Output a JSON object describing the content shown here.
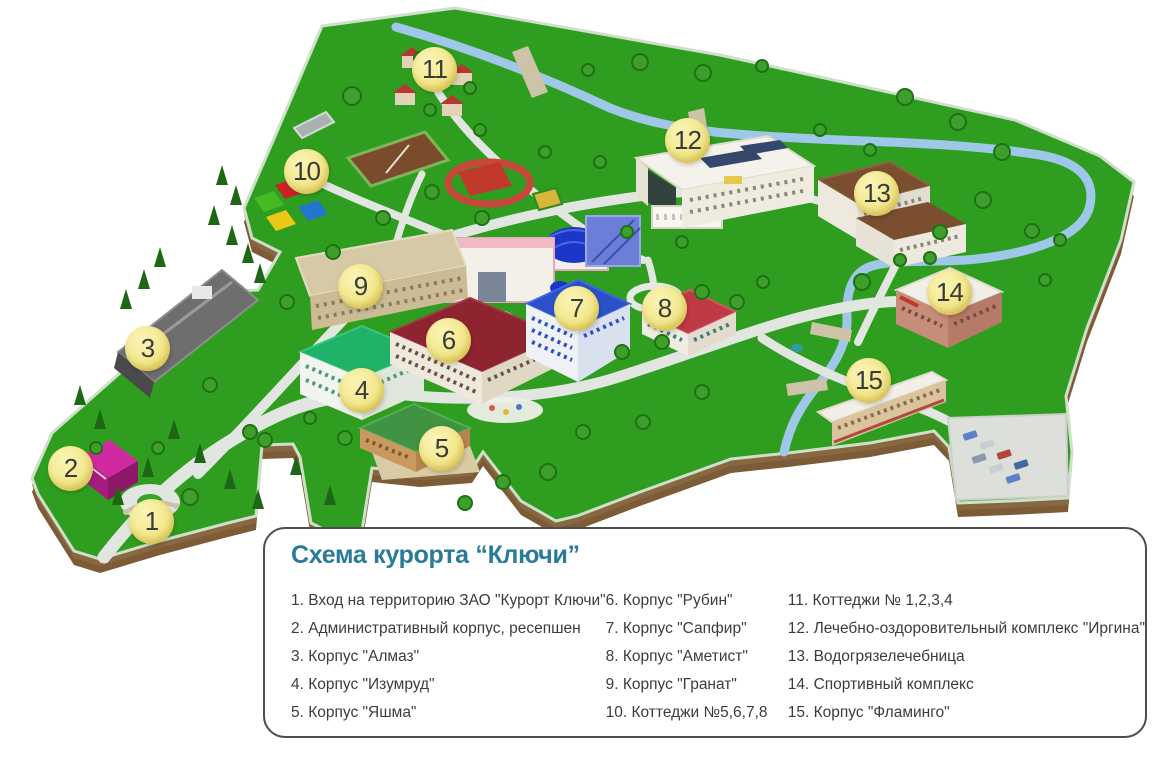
{
  "page": {
    "background": "#FFFFFF"
  },
  "legend": {
    "title": "Схема курорта “Ключи”",
    "title_color": "#2A7A99",
    "items_per_column": 5
  },
  "map": {
    "marker_style": {
      "fill": "#F3E88E",
      "text_color": "#3A3A3A"
    },
    "colors": {
      "land": "#2F9E20",
      "river": "#9FC7E8",
      "road": "#E2E6E1",
      "cliff": "#7C5B36"
    },
    "markers": [
      {
        "number": "1",
        "label": "Вход на территорию ЗАО \"Курорт Ключи\"",
        "x": 152,
        "y": 522
      },
      {
        "number": "2",
        "label": "Административный корпус, ресепшен",
        "x": 71,
        "y": 469
      },
      {
        "number": "3",
        "label": "Корпус \"Алмаз\"",
        "x": 148,
        "y": 349
      },
      {
        "number": "4",
        "label": "Корпус \"Изумруд\"",
        "x": 362,
        "y": 391
      },
      {
        "number": "5",
        "label": "Корпус \"Яшма\"",
        "x": 442,
        "y": 449
      },
      {
        "number": "6",
        "label": "Корпус \"Рубин\"",
        "x": 449,
        "y": 341
      },
      {
        "number": "7",
        "label": "Корпус \"Сапфир\"",
        "x": 577,
        "y": 309
      },
      {
        "number": "8",
        "label": "Корпус \"Аметист\"",
        "x": 665,
        "y": 309
      },
      {
        "number": "9",
        "label": "Корпус \"Гранат\"",
        "x": 361,
        "y": 287
      },
      {
        "number": "10",
        "label": "Коттеджи №5,6,7,8",
        "x": 307,
        "y": 172
      },
      {
        "number": "11",
        "label": "Коттеджи № 1,2,3,4",
        "x": 435,
        "y": 70
      },
      {
        "number": "12",
        "label": "Лечебно-оздоровительный комплекс \"Иргина\"",
        "x": 688,
        "y": 141
      },
      {
        "number": "13",
        "label": "Водогрязелечебница",
        "x": 877,
        "y": 194
      },
      {
        "number": "14",
        "label": "Спортивный комплекс",
        "x": 950,
        "y": 293
      },
      {
        "number": "15",
        "label": "Корпус \"Фламинго\"",
        "x": 869,
        "y": 381
      }
    ]
  }
}
